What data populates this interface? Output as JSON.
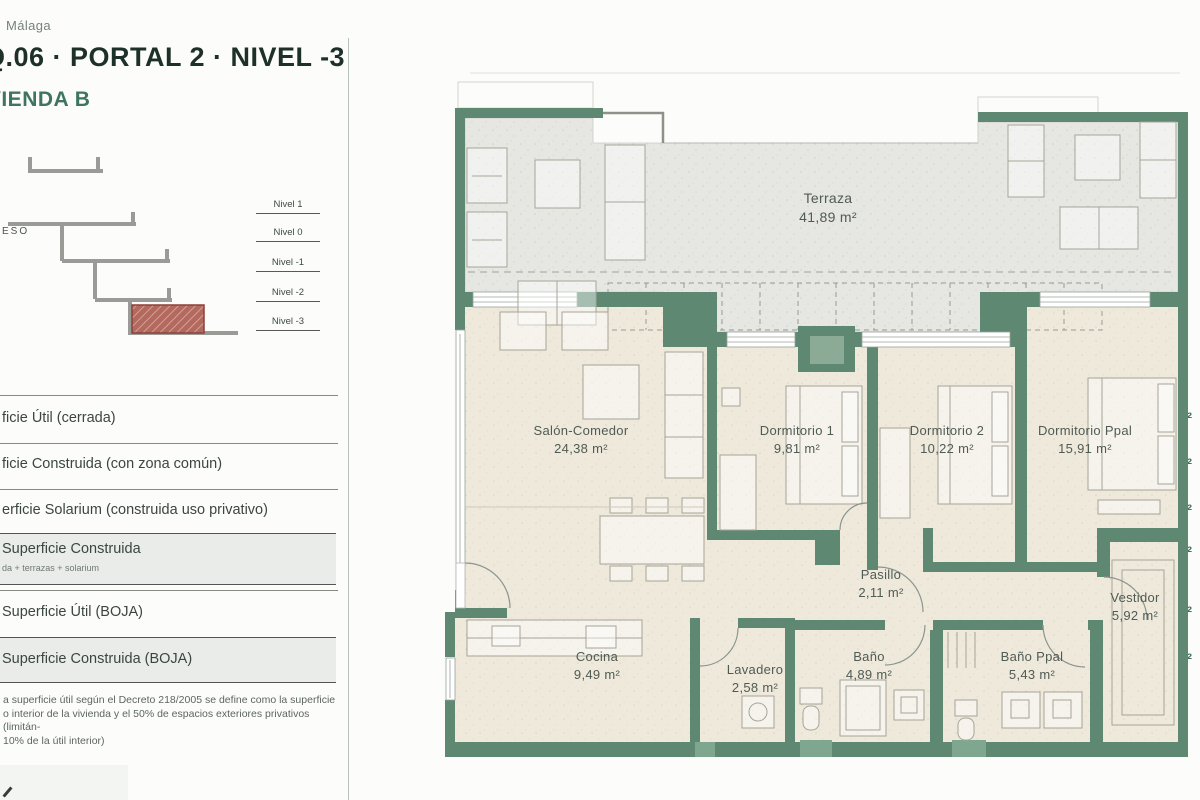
{
  "header": {
    "location": "Málaga",
    "title": "Q.06 · PORTAL 2 · NIVEL -3",
    "unit_name": "VIVIENDA B"
  },
  "section": {
    "entry_label": "GRESO",
    "levels": [
      "Nivel 1",
      "Nivel 0",
      "Nivel -1",
      "Nivel -2",
      "Nivel -3"
    ]
  },
  "areas_table": {
    "rows": [
      {
        "label": "ficie Útil (cerrada)",
        "value": "92.54 m²"
      },
      {
        "label": "ficie Construida (con zona común)",
        "value": "144.00m²"
      },
      {
        "label": "erficie Solarium (construida uso privativo)",
        "value": "47.49 m²"
      },
      {
        "label": "Superficie Construida",
        "sublabel": "da + terrazas + solarium",
        "value": "191.49 m²"
      },
      {
        "label": "Superficie Útil (BOJA)",
        "value": "101.79 m²"
      },
      {
        "label": "Superficie Construida (BOJA)",
        "value": "158.40 m²"
      }
    ]
  },
  "footnote": {
    "line1": "a superficie útil según el Decreto 218/2005 se define como la superficie",
    "line2": "o interior de la vivienda y el 50% de espacios exteriores privativos (limitán-",
    "line3": "10% de la útil interior)"
  },
  "floor_plan": {
    "rooms": [
      {
        "name": "Terraza",
        "area": "41,89 m²"
      },
      {
        "name": "Salón-Comedor",
        "area": "24,38 m²"
      },
      {
        "name": "Dormitorio 1",
        "area": "9,81 m²"
      },
      {
        "name": "Dormitorio 2",
        "area": "10,22 m²"
      },
      {
        "name": "Dormitorio Ppal",
        "area": "15,91 m²"
      },
      {
        "name": "Pasillo",
        "area": "2,11 m²"
      },
      {
        "name": "Cocina",
        "area": "9,49 m²"
      },
      {
        "name": "Lavadero",
        "area": "2,58 m²"
      },
      {
        "name": "Baño",
        "area": "4,89 m²"
      },
      {
        "name": "Baño Ppal",
        "area": "5,43 m²"
      },
      {
        "name": "Vestidor",
        "area": "5,92 m²"
      }
    ]
  },
  "colors": {
    "wall_green": "#5e8872",
    "accent_green": "#3f7560",
    "title_dark": "#1d302a",
    "hatch_red": "#b4695e"
  }
}
